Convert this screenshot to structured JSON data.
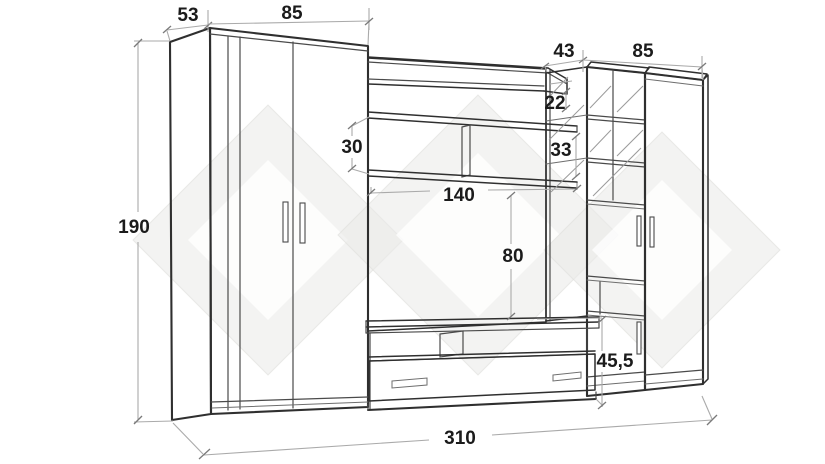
{
  "dimensions": {
    "wardrobe_depth": "53",
    "wardrobe_width": "85",
    "display_unit_depth": "43",
    "cabinet_width": "85",
    "total_height": "190",
    "total_width": "310",
    "top_shelf_height": "22",
    "shelf_gap_left": "30",
    "shelf_gap_right": "33",
    "shelf_length": "140",
    "tv_niche_height": "80",
    "tv_stand_height": "45,5"
  },
  "colors": {
    "background": "#ffffff",
    "outline": "#2f2f2f",
    "detail": "#4a4a4a",
    "dimension_line": "#aaaaaa",
    "dimension_text": "#1b1b1b",
    "watermark": "#e9e9e7"
  }
}
